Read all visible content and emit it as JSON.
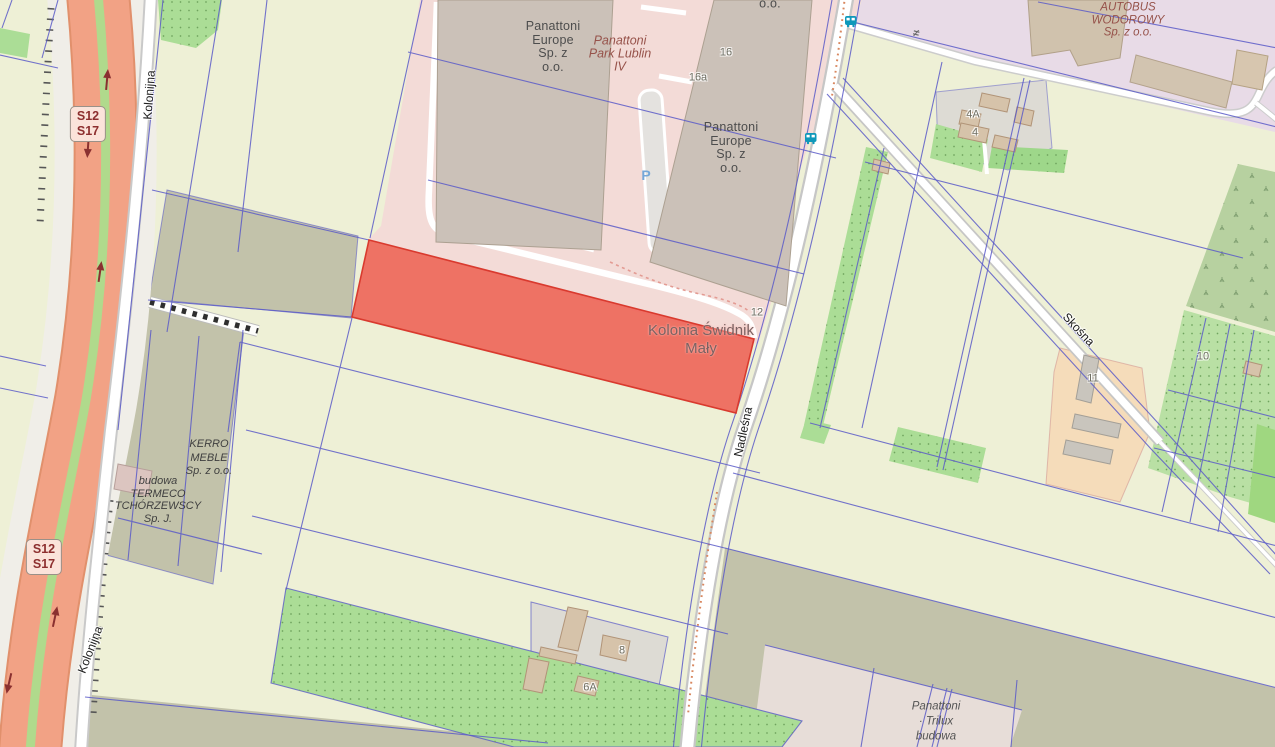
{
  "map_title": "Kolonia Świdnik Mały cadastral map with highlighted parcel",
  "colors": {
    "farmland": "#eef0d6",
    "parcel_line": "#5a5ac8",
    "highlight_fill": "#ee6054",
    "highlight_stroke": "#d93a2e",
    "motorway": "#f2a285",
    "motorway_casing": "#e1906c",
    "median_green": "#b0da8c",
    "road_white": "#ffffff",
    "industrial_pink": "#f3dbd7",
    "retail_lavender": "#e8dbe7",
    "residential_gray": "#dddbd4",
    "farmyard_orange": "#f5dcba",
    "orchard_green": "#abdd96",
    "scrub_green": "#b7d1a0",
    "olive_strip": "#c2c2aa",
    "construction_pink": "#e7ddd8",
    "warehouse": "#cbc1b8",
    "house": "#d6c3aa",
    "bus_icon": "#0e98ba",
    "shield_bg": "#fbe3da",
    "shield_text": "#8d2f2f",
    "parking_blue": "#76a7d8"
  },
  "road_shields": {
    "top": "S12\nS17",
    "bottom": "S12\nS17"
  },
  "street_labels": {
    "kolonijna_top": "Kolonijna",
    "kolonijna_bottom": "Kolonijna",
    "nadlesna": "Nadleśna",
    "skosna": "Skośna"
  },
  "place_labels": {
    "kolonia_swidnik_maly": "Kolonia Świdnik\nMały"
  },
  "poi_labels": {
    "panattoni_left": "Panattoni\nEurope\nSp. z\no.o.",
    "panattoni_park": "Panattoni\nPark Lublin\nIV",
    "panattoni_right": "Panattoni\nEurope\nSp. z\no.o.",
    "autobus_wodorowy": "AUTOBUS\nWODOROWY\nSp. z o.o.",
    "kerro_meble": "KERRO\nMEBLE\nSp. z o.o.",
    "termeco": "budowa\nTERMECO\nTCHÓRZEWSCY\nSp. J.",
    "panattoni_trilux": "Panattoni\n· Trilux\nbudowa",
    "partial_top": "o.o."
  },
  "house_numbers": {
    "n16": "16",
    "n16a": "16a",
    "n12": "12",
    "n4a": "4A",
    "n4": "4",
    "n8": "8",
    "n6a": "6A",
    "n11": "11",
    "n10": "10"
  },
  "icons": {
    "parking": "P",
    "gate": "≠",
    "bus_stop": "bus-icon"
  }
}
